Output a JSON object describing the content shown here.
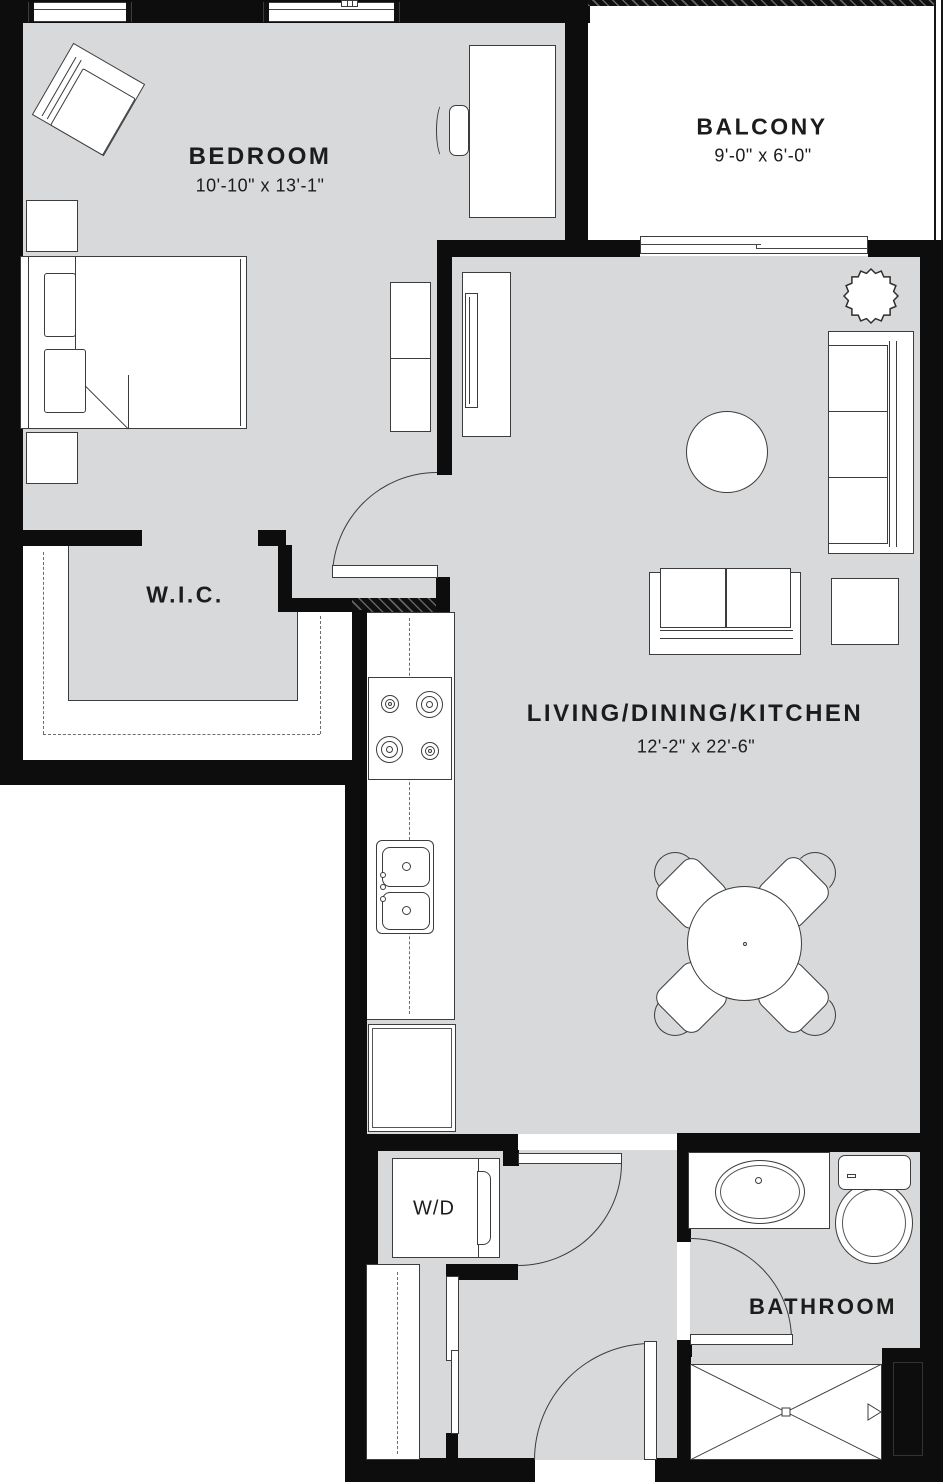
{
  "colors": {
    "floor": "#d8d9da",
    "wall": "#0d0d0d",
    "line": "#3c3c3c",
    "text": "#1c1c1c",
    "paper": "#ffffff"
  },
  "rooms": {
    "bedroom": {
      "label": "BEDROOM",
      "dims": "10'-10\" x 13'-1\""
    },
    "balcony": {
      "label": "BALCONY",
      "dims": "9'-0\" x 6'-0\""
    },
    "wic": {
      "label": "W.I.C."
    },
    "living": {
      "label": "LIVING/DINING/KITCHEN",
      "dims": "12'-2\" x 22'-6\""
    },
    "laundry": {
      "label": "W/D"
    },
    "bathroom": {
      "label": "BATHROOM"
    }
  },
  "icons": [
    "window-icon",
    "sliding-door-icon",
    "door-swing-icon",
    "bed-icon",
    "lounge-chair-icon",
    "nightstand-icon",
    "dresser-icon",
    "desk-icon",
    "desk-chair-icon",
    "tv-console-icon",
    "plant-icon",
    "sofa-icon",
    "loveseat-icon",
    "side-table-icon",
    "coffee-table-icon",
    "dining-table-icon",
    "dining-chair-icon",
    "cooktop-icon",
    "kitchen-sink-icon",
    "refrigerator-icon",
    "washer-dryer-icon",
    "closet-rod-icon",
    "vanity-sink-icon",
    "toilet-icon",
    "shower-icon"
  ]
}
